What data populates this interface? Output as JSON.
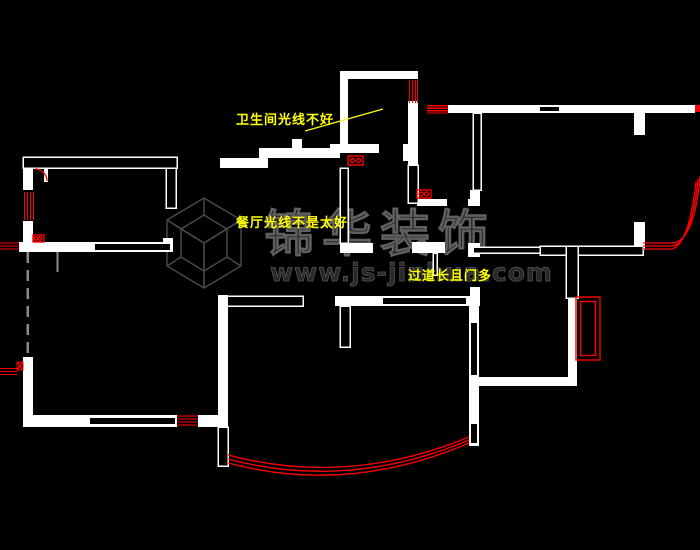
{
  "canvas": {
    "width": 700,
    "height": 550,
    "background": "#000000"
  },
  "colors": {
    "wall": "#ffffff",
    "window": "#ff0000",
    "annotation": "#ffff00",
    "watermark_fill": "#282828",
    "watermark_edge": "#606060",
    "dashed_line": "#8a8a8a"
  },
  "annotations": {
    "bathroom_note": "卫生间光线不好",
    "dining_note": "餐厅光线不是太好",
    "corridor_note": "过道长且门多"
  },
  "watermark": {
    "brand": "锦华装饰",
    "website": "www.js-jinhua.com"
  }
}
